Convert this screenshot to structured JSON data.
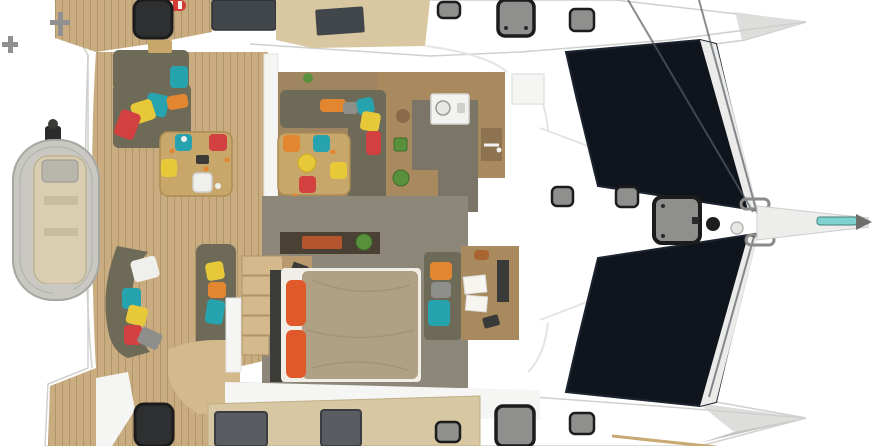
{
  "scene": {
    "title": "Catamaran deck and interior layout - top view 3D render",
    "view": "top-down cutaway",
    "areas": [
      "aft swim platform with cleats",
      "tender dinghy with outboard motor on davits",
      "aft cockpit lounge with cushions",
      "cockpit dining table with four stools",
      "salon dining table with stools and L-sofa",
      "galley with stove, sink and plants",
      "owner cabin with double bed and orange pillows",
      "chart desk with papers and laptop",
      "companionway steps",
      "foredeck with deck hatches and anchor locker",
      "bow trampolines",
      "bowsprit with windlass and fittings"
    ],
    "furniture": {
      "tables": 2,
      "stool_colors": [
        "teal",
        "red",
        "yellow",
        "white",
        "orange"
      ],
      "pillow_colors": [
        "teal",
        "red",
        "yellow",
        "orange",
        "gray",
        "white"
      ],
      "bed": "double berth with khaki duvet and two orange pillows",
      "deck_hatches": 12
    }
  },
  "palette": {
    "background": "#ffffff",
    "hull_white": "#f5f5f4",
    "hull_shade": "#dddddc",
    "hull_shade_dark": "#c4c4c2",
    "hull_edge": "#cfcfcd",
    "seam": "#e4e4e2",
    "band_white": "#ebebea",
    "teak": "#c9ad80",
    "teak_line": "#b0946a",
    "beige_top": "#d8c7a0",
    "beige_platform": "#d7c7a2",
    "beige_step": "#d3b98c",
    "salon_floor": "#9f8560",
    "counter_brown": "#a88a5e",
    "counter_dark": "#8d7350",
    "galley_floor": "#7b7568",
    "cabin_floor": "#8d877a",
    "sofa_olive": "#6d6a58",
    "table_wood": "#c8a76b",
    "table_wood_edge": "#ad8c54",
    "tramp_navy": "#10151d",
    "tramp_edge": "#1c2430",
    "hatch_black": "#2e2f30",
    "hatch_frame": "#1c1c1c",
    "hatch_gray": "#8f8f8d",
    "hatch_gray_dark": "#595c60",
    "window_dark": "#41464a",
    "dinghy_tube": "#c9c8c3",
    "dinghy_tube_line": "#a7a7a2",
    "dinghy_floor": "#d9cdb2",
    "console_gray": "#b9b6ae",
    "motor_dark": "#2b2b2b",
    "metal_gray": "#909090",
    "pillow_teal": "#27a3b0",
    "pillow_red": "#d24040",
    "pillow_yellow": "#e6c838",
    "pillow_orange": "#e2862f",
    "pillow_gray": "#8e8e8a",
    "pillow_white": "#efefec",
    "bed_duvet": "#b0a184",
    "bed_sheet": "#f0eee7",
    "bed_pillow": "#e0592a",
    "headboard": "#3c3c38",
    "plant_green": "#59903c",
    "plant_pot": "#8a6a4a",
    "tray_orange": "#b4552e",
    "paper_white": "#f6f5f0",
    "stove_white": "#f2f2f0",
    "red_buoy": "#d23c34",
    "teal_strip": "#7fd2cd",
    "rig_line": "#555c63",
    "item_dark": "#3a3a38"
  }
}
